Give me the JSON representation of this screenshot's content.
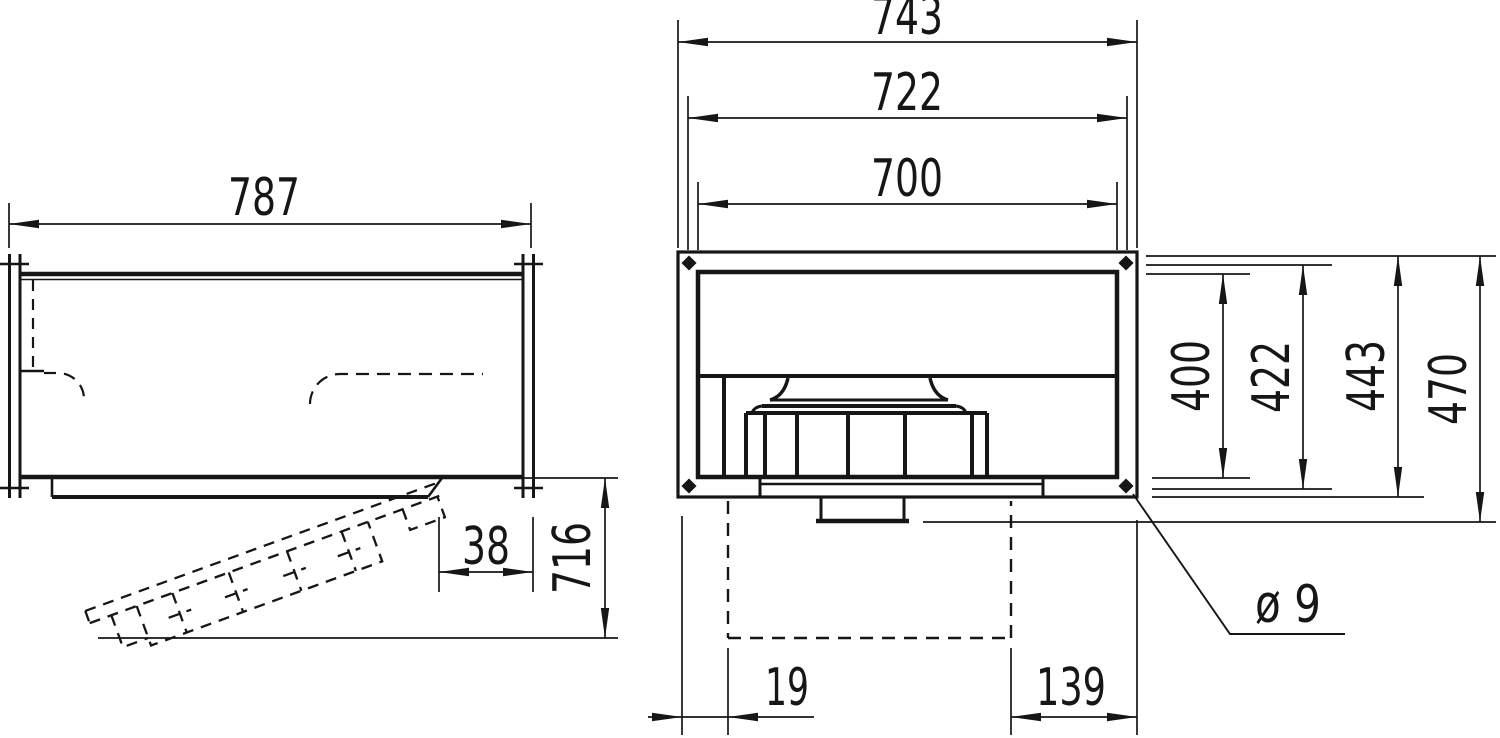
{
  "drawing": {
    "type": "technical-dimension-drawing",
    "colors": {
      "background": "#ffffff",
      "line": "#161616"
    },
    "views": {
      "left": "side-view",
      "right": "front-view"
    }
  },
  "dimensions": {
    "side_width": "787",
    "side_panel_gap": "38",
    "side_open_clearance": "716",
    "front_outer_width": "743",
    "front_bolt_width": "722",
    "front_duct_width": "700",
    "front_duct_height": "400",
    "front_bolt_height": "422",
    "front_outer_height": "443",
    "front_total_height": "470",
    "hole_note": "ø 9",
    "bottom_offset_left": "19",
    "bottom_offset_right": "139"
  }
}
